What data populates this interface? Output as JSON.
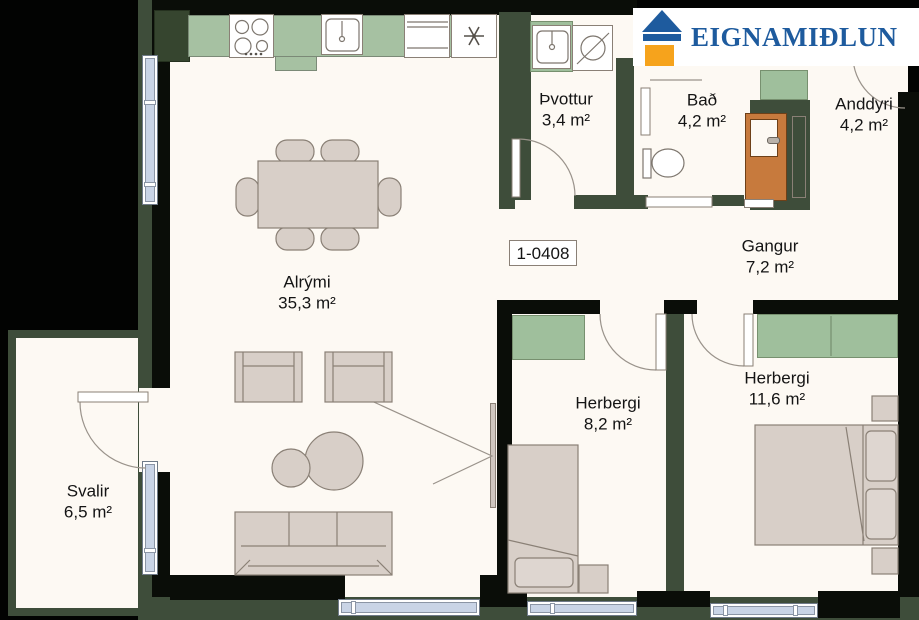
{
  "brand": {
    "name": "EIGNAMIÐLUN"
  },
  "plan_number": "1-0408",
  "rooms": [
    {
      "id": "alrymi",
      "name": "Alrými",
      "area": "35,3 m²"
    },
    {
      "id": "svalir",
      "name": "Svalir",
      "area": "6,5 m²"
    },
    {
      "id": "thvottur",
      "name": "Þvottur",
      "area": "3,4 m²"
    },
    {
      "id": "bad",
      "name": "Bað",
      "area": "4,2 m²"
    },
    {
      "id": "anddyri",
      "name": "Anddyri",
      "area": "4,2 m²"
    },
    {
      "id": "gangur",
      "name": "Gangur",
      "area": "7,2 m²"
    },
    {
      "id": "herbergi-1",
      "name": "Herbergi",
      "area": "8,2 m²"
    },
    {
      "id": "herbergi-2",
      "name": "Herbergi",
      "area": "11,6 m²"
    }
  ],
  "icons": {
    "logo_house": "house-icon",
    "freezer_symbol": "asterisk-icon"
  },
  "colors": {
    "background": "#020302",
    "floor": "#fdf9f3",
    "wall_green": "#3e4d3a",
    "wall_black": "#0a0d08",
    "cabinet_sage": "#9fbf9c",
    "furniture_beige": "#d8cfc8",
    "window_glass": "#c9d4e6",
    "entrance_door_orange": "#c77a3d",
    "logo_blue": "#1e5b9e",
    "logo_orange": "#f6a31c"
  }
}
